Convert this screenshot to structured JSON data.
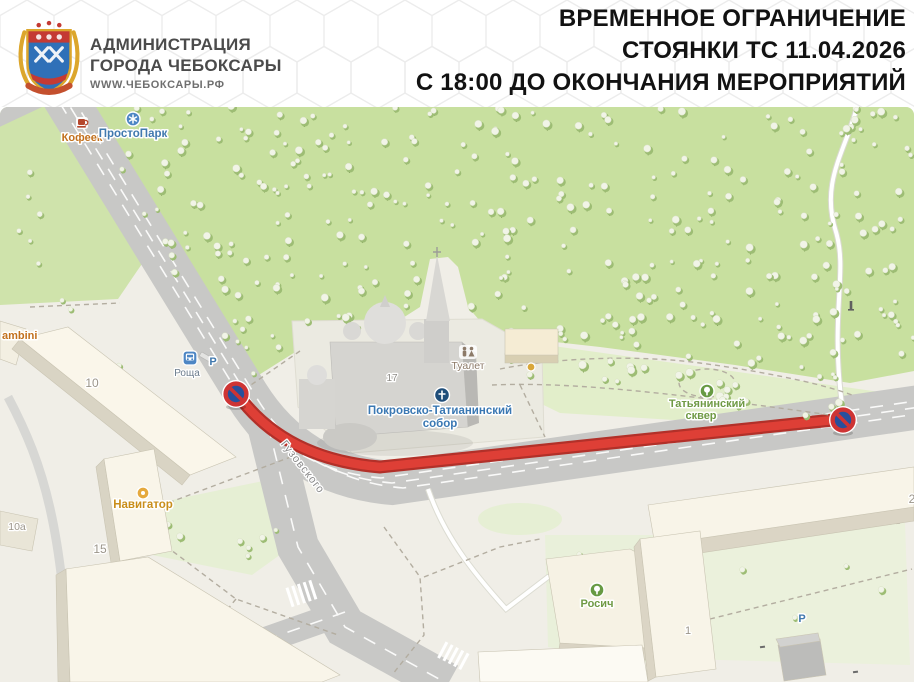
{
  "header": {
    "org": {
      "line1": "АДМИНИСТРАЦИЯ",
      "line2": "ГОРОДА ЧЕБОКСАРЫ",
      "url": "WWW.ЧЕБОКСАРЫ.РФ",
      "logo": "cheboksary-coat-of-arms"
    },
    "notice": {
      "line1": "ВРЕМЕННОЕ ОГРАНИЧЕНИЕ",
      "line2": "СТОЯНКИ ТС 11.04.2026",
      "line3": "С 18:00 ДО ОКОНЧАНИЯ МЕРОПРИЯТИЙ"
    }
  },
  "map": {
    "street_label": "Гузовского",
    "pois": {
      "kofeek": "Кофеек",
      "prostopark": "ПростоПарк",
      "roscha": "Роща",
      "parking1": "Р",
      "parking2": "Р",
      "sobor_line1": "Покровско-Татианинский",
      "sobor_line2": "собор",
      "tualet": "Туалет",
      "skver_line1": "Татьянинский",
      "skver_line2": "сквер",
      "navigator": "Навигатор",
      "rosich": "Росич",
      "bambini": "ambini"
    },
    "house_numbers": {
      "h10": "10",
      "h10a": "10а",
      "h15": "15",
      "h17": "17",
      "h1": "1",
      "h2": "2"
    },
    "signs": {
      "left": "no-parking-sign",
      "right": "no-parking-sign"
    }
  },
  "colors": {
    "route_red": "#de3f36",
    "route_red_dark": "#b23029",
    "sign_ring_red": "#ce3434",
    "sign_disc_blue": "#27509d",
    "forest_green": "#c8e09f",
    "road_gray": "#c8c8c6",
    "notice_text": "#121212"
  }
}
